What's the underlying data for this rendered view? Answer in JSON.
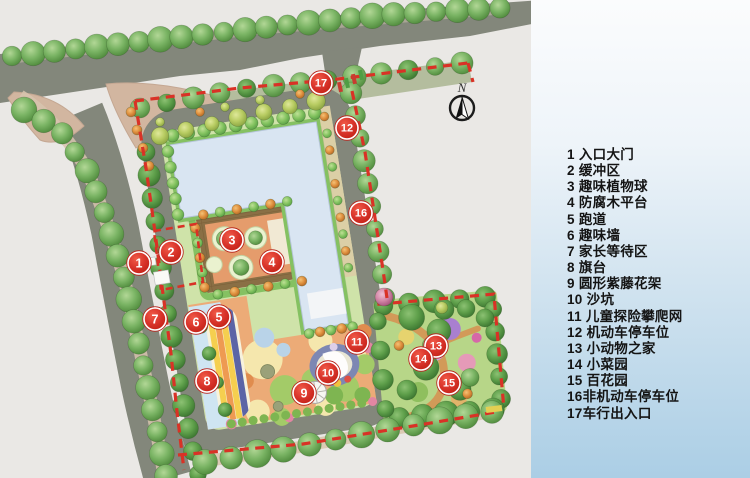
{
  "north_label": "N",
  "legend": {
    "items": [
      "1 入口大门",
      "2 缓冲区",
      "3 趣味植物球",
      "4 防腐木平台",
      "5 跑道",
      "6 趣味墙",
      "7 家长等待区",
      "8 旗台",
      "9 圆形紫藤花架",
      "10 沙坑",
      "11 儿童探险攀爬网",
      "12 机动车停车位",
      "13 小动物之家",
      "14 小菜园",
      "15 百花园",
      "16非机动车停车位",
      "17车行出入口"
    ]
  },
  "markers": [
    {
      "n": "1",
      "x": 139,
      "y": 263
    },
    {
      "n": "2",
      "x": 171,
      "y": 252
    },
    {
      "n": "3",
      "x": 232,
      "y": 240
    },
    {
      "n": "4",
      "x": 272,
      "y": 262
    },
    {
      "n": "5",
      "x": 219,
      "y": 317
    },
    {
      "n": "6",
      "x": 196,
      "y": 322
    },
    {
      "n": "7",
      "x": 155,
      "y": 319
    },
    {
      "n": "8",
      "x": 207,
      "y": 381
    },
    {
      "n": "9",
      "x": 304,
      "y": 393
    },
    {
      "n": "10",
      "x": 328,
      "y": 373
    },
    {
      "n": "11",
      "x": 357,
      "y": 342
    },
    {
      "n": "12",
      "x": 347,
      "y": 128
    },
    {
      "n": "13",
      "x": 436,
      "y": 346
    },
    {
      "n": "14",
      "x": 421,
      "y": 359
    },
    {
      "n": "15",
      "x": 449,
      "y": 383
    },
    {
      "n": "16",
      "x": 361,
      "y": 213
    },
    {
      "n": "17",
      "x": 321,
      "y": 83
    }
  ],
  "colors": {
    "marker_red": "#d8332a",
    "marker_red_dark": "#b8271f",
    "boundary_red": "#d93226",
    "road_gray": "#83877b",
    "building_blue": "#d9e5f2",
    "lawn_green": "#cfe3a9",
    "panel_blue": "#abcee5",
    "tree_green": "#6fae58"
  }
}
